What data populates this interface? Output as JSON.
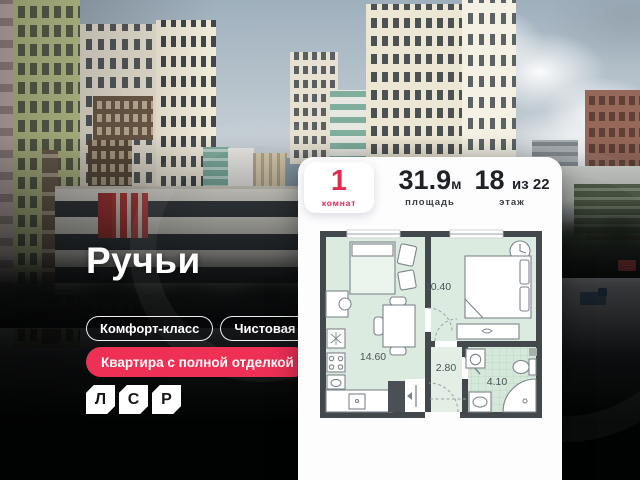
{
  "project": {
    "name": "Ручьи",
    "developer_logo": {
      "letters": [
        "Л",
        "С",
        "Р"
      ]
    }
  },
  "badges": {
    "class": "Комфорт-класс",
    "finish": "Чистовая",
    "promo": "Квартира с полной отделкой"
  },
  "listing_card": {
    "rooms": {
      "value": "1",
      "label": "комнат"
    },
    "area": {
      "value": "31.9",
      "unit": "м",
      "label": "площадь"
    },
    "floor": {
      "value": "18",
      "of": "из 22",
      "label": "этаж"
    },
    "floorplan": {
      "rooms": [
        {
          "name": "kitchen-living-room",
          "area": "14.60"
        },
        {
          "name": "bedroom",
          "area": "10.40"
        },
        {
          "name": "hallway",
          "area": "2.80"
        },
        {
          "name": "bathroom",
          "area": "4.10"
        }
      ]
    }
  },
  "colors": {
    "accent_red": "#ee3054",
    "stat_red": "#e12b51",
    "plan_wall": "#43484d",
    "plan_floor_mint": "#dcebdf"
  }
}
